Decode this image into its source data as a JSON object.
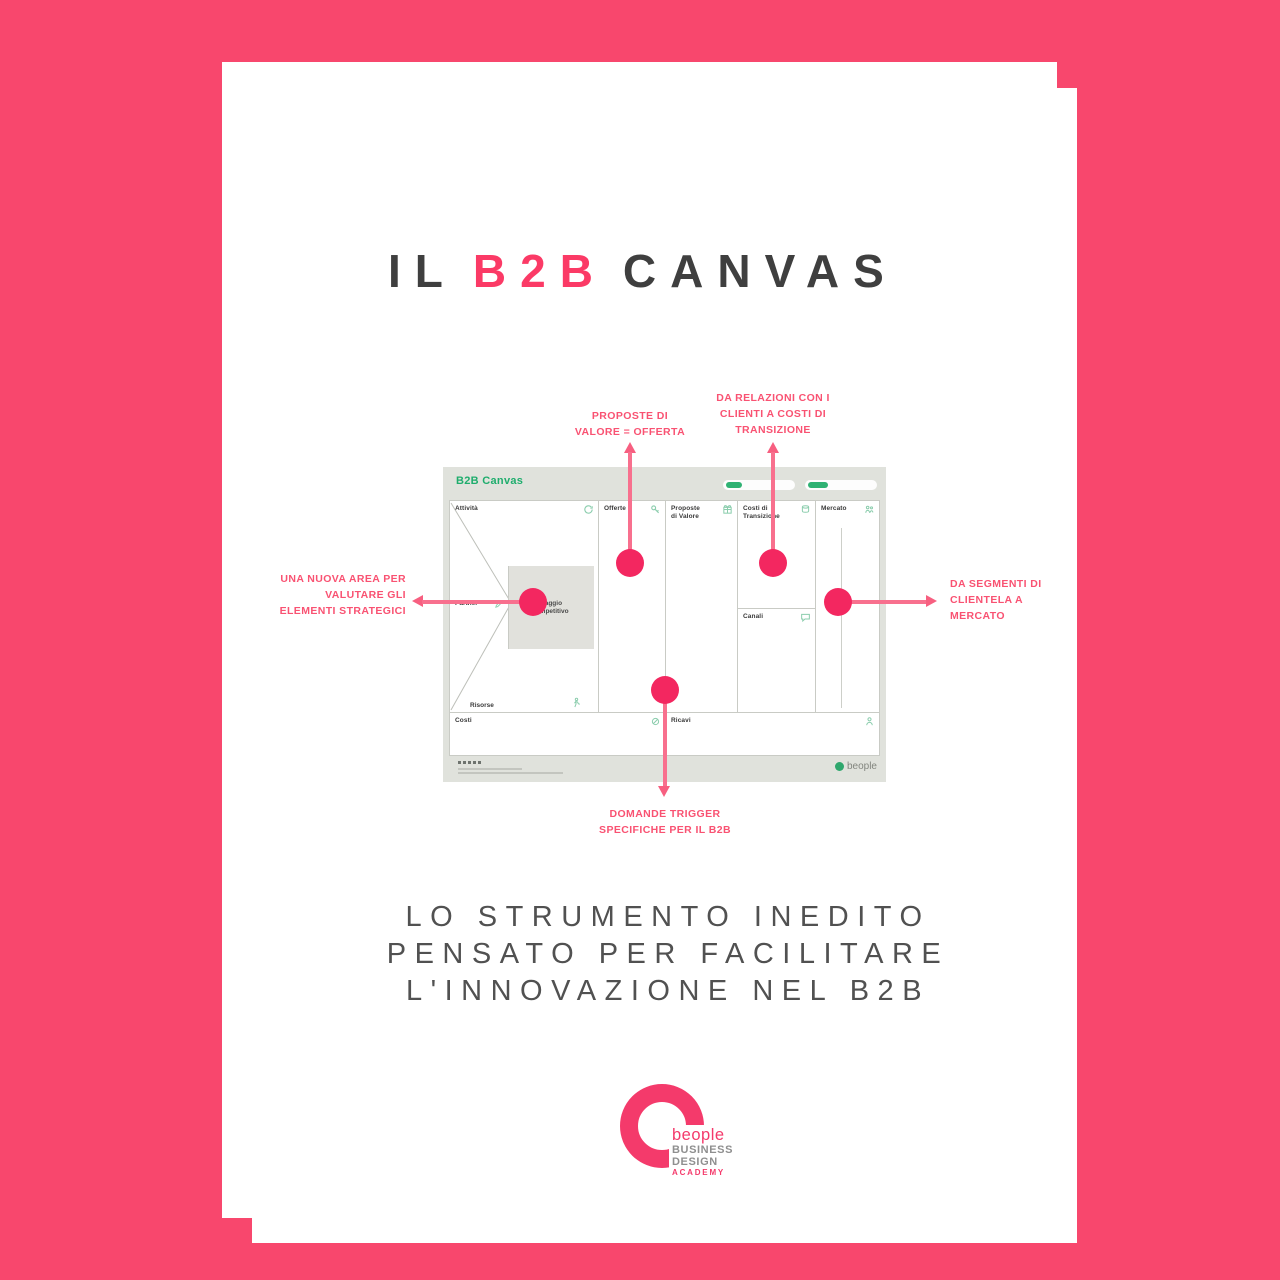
{
  "title": {
    "part1": "IL",
    "part2": "B2B",
    "part3": "CANVAS"
  },
  "annotations": {
    "proposte": {
      "lines": [
        "PROPOSTE DI",
        "VALORE = OFFERTA"
      ]
    },
    "relazioni": {
      "lines": [
        "DA RELAZIONI CON I",
        "CLIENTI A COSTI DI",
        "TRANSIZIONE"
      ]
    },
    "nuova_area": {
      "lines": [
        "UNA NUOVA AREA PER",
        "VALUTARE GLI",
        "ELEMENTI STRATEGICI"
      ]
    },
    "segmenti": {
      "lines": [
        "DA SEGMENTI DI",
        "CLIENTELA A",
        "MERCATO"
      ]
    },
    "domande": {
      "lines": [
        "DOMANDE TRIGGER",
        "SPECIFICHE PER IL B2B"
      ]
    }
  },
  "canvas": {
    "header_title": "B2B Canvas",
    "sections": {
      "attivita": "Attività",
      "offerte": "Offerte",
      "proposte": {
        "lines": [
          "Proposte",
          "di Valore"
        ]
      },
      "costi_transizione": {
        "lines": [
          "Costi di",
          "Transizione"
        ]
      },
      "canali": "Canali",
      "mercato": "Mercato",
      "partner": "Partner",
      "risorse": "Risorse",
      "costi": "Costi",
      "ricavi": "Ricavi",
      "vantaggio": {
        "lines": [
          "Vantaggio",
          "Competitivo"
        ]
      }
    },
    "footer_brand": "beople"
  },
  "subtitle": {
    "lines": [
      "LO STRUMENTO INEDITO",
      "PENSATO PER FACILITARE",
      "L'INNOVAZIONE NEL B2B"
    ]
  },
  "logo": {
    "name": "beople",
    "line1": "BUSINESS",
    "line2": "DESIGN",
    "line3": "ACADEMY"
  },
  "colors": {
    "background_pink": "#F8476D",
    "accent_dot_pink": "#F32760",
    "accent_line_pink": "#F8708E",
    "annotation_text_pink": "#F95272",
    "title_pink": "#FB3A66",
    "title_dark": "#3F3F3F",
    "subtitle_gray": "#515151",
    "canvas_green": "#1FAD6D",
    "icon_green": "#8BCDAD",
    "canvas_bg": "#E0E2DC"
  }
}
